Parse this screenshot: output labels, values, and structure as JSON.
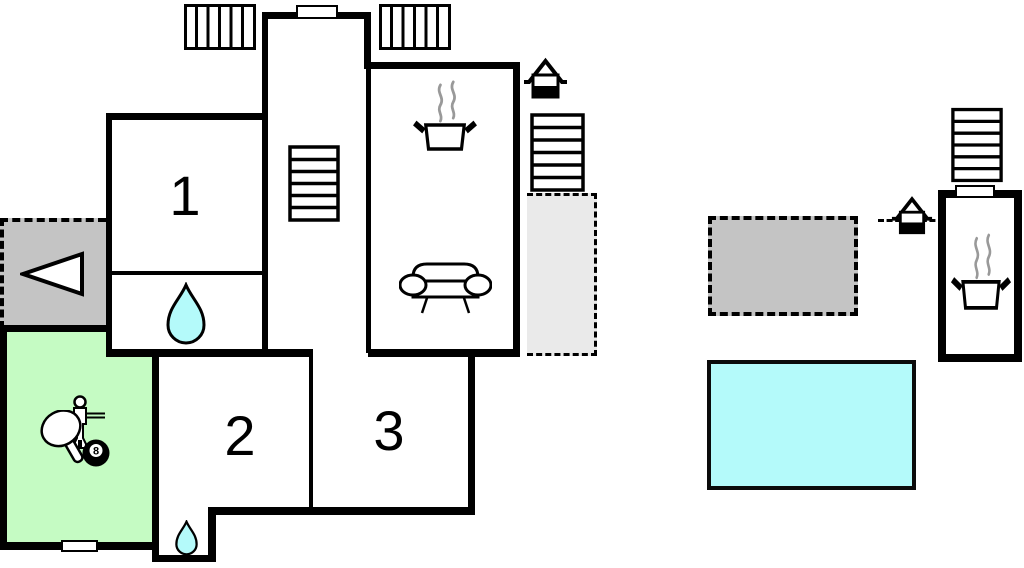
{
  "title": "holiday-home-floor-plan",
  "colors": {
    "wall": "#000000",
    "water_fill": "#b4fafa",
    "game_room_fill": "#c5fbc3",
    "terrace_fill": "#c4c4c4",
    "patio_fill": "#eaeaea",
    "steam": "#999999"
  },
  "rooms": [
    {
      "id": "bedroom-1",
      "label": "1"
    },
    {
      "id": "bedroom-2",
      "label": "2"
    },
    {
      "id": "bedroom-3",
      "label": "3"
    }
  ],
  "game_room": {
    "eight_ball_label": "8",
    "icons": [
      "foosball-player-icon",
      "table-tennis-paddle-icon",
      "billiard-eight-ball-icon"
    ]
  },
  "icons": {
    "staircase": "staircase-icon",
    "cooking_pot": "cooking-pot-icon",
    "steam": "steam-icon",
    "sofa": "sofa-icon",
    "water_drop": "water-drop-icon",
    "well": "well-icon",
    "exterior_stairs": "exterior-stairs-icon",
    "radiator": "radiator-icon",
    "entrance_arrow": "entrance-arrow-icon",
    "window": "window-marker"
  },
  "areas": {
    "terrace_left": "terrace",
    "patio_side": "patio",
    "terrace_right": "terrace",
    "pool": "swimming-pool",
    "game_room": "game-room",
    "annex": "annex-building",
    "bathroom": "bathroom",
    "small_bathroom": "small-bathroom",
    "living_room": "living-room",
    "hall": "hall",
    "corridor": "corridor"
  }
}
